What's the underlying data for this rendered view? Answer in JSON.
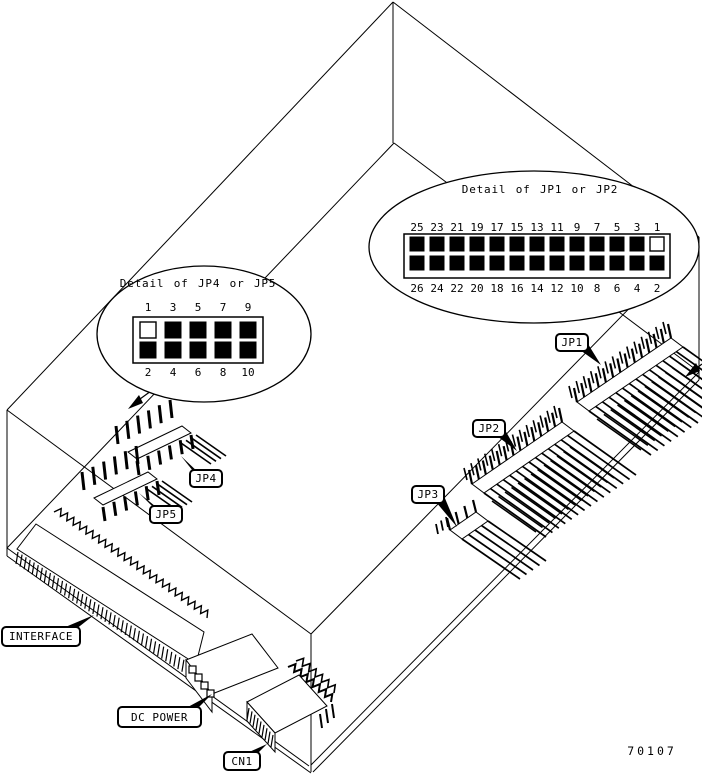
{
  "figure": {
    "part_number": "70107"
  },
  "details": {
    "right": {
      "title": "Detail of JP1 or JP2",
      "top_pins": [
        "25",
        "23",
        "21",
        "19",
        "17",
        "15",
        "13",
        "11",
        "9",
        "7",
        "5",
        "3",
        "1"
      ],
      "bottom_pins": [
        "26",
        "24",
        "22",
        "20",
        "18",
        "16",
        "14",
        "12",
        "10",
        "8",
        "6",
        "4",
        "2"
      ],
      "open_pin_label": "1"
    },
    "left": {
      "title": "Detail of JP4 or JP5",
      "top_pins": [
        "1",
        "3",
        "5",
        "7",
        "9"
      ],
      "bottom_pins": [
        "2",
        "4",
        "6",
        "8",
        "10"
      ],
      "open_pin_label": "1"
    }
  },
  "labels": {
    "jp1": "JP1",
    "jp2": "JP2",
    "jp3": "JP3",
    "jp4": "JP4",
    "jp5": "JP5",
    "interface": "INTERFACE",
    "dc_power": "DC POWER",
    "cn1": "CN1"
  },
  "colors": {
    "line": "#000000",
    "background": "#ffffff",
    "pin_filled": "#000000",
    "pin_open": "#ffffff"
  }
}
